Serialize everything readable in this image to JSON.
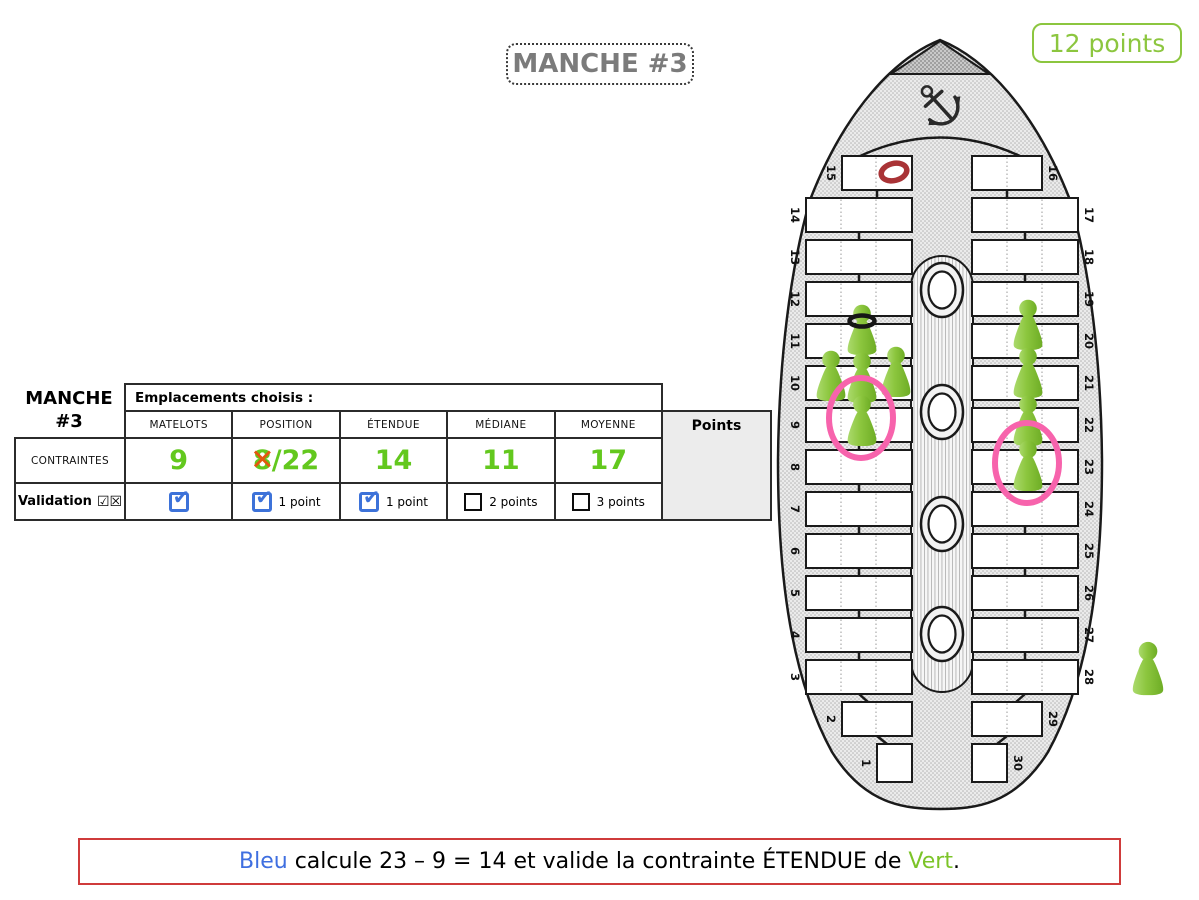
{
  "title_box": {
    "label": "MANCHE #3"
  },
  "score_badge": {
    "label": "12 points",
    "color": "#8CC63F"
  },
  "table": {
    "round_label_line1": "MANCHE",
    "round_label_line2": "#3",
    "header_span": "Emplacements choisis :",
    "points_header": "Points",
    "columns": [
      "MATELOTS",
      "POSITION",
      "ÉTENDUE",
      "MÉDIANE",
      "MOYENNE"
    ],
    "contraintes": {
      "label": "CONTRAINTES",
      "values": [
        {
          "struck": "",
          "text": "9"
        },
        {
          "struck": "8",
          "text": "/22"
        },
        {
          "struck": "",
          "text": "14"
        },
        {
          "struck": "",
          "text": "11"
        },
        {
          "struck": "",
          "text": "17"
        }
      ],
      "value_color": "#63C81E",
      "strike_color": "#E2570F"
    },
    "validation": {
      "label": "Validation",
      "glyphs": "☑☒",
      "cells": [
        {
          "checked": true,
          "points_label": ""
        },
        {
          "checked": true,
          "points_label": "1 point"
        },
        {
          "checked": true,
          "points_label": "1 point"
        },
        {
          "checked": false,
          "points_label": "2 points"
        },
        {
          "checked": false,
          "points_label": "3 points"
        }
      ],
      "check_color": "#3D72D9"
    }
  },
  "boat": {
    "left_numbers": [
      "15",
      "14",
      "13",
      "12",
      "11",
      "10",
      "9",
      "8",
      "7",
      "6",
      "5",
      "4",
      "3",
      "2",
      "1"
    ],
    "right_numbers": [
      "16",
      "17",
      "18",
      "19",
      "20",
      "21",
      "22",
      "23",
      "24",
      "25",
      "26",
      "27",
      "28",
      "29",
      "30"
    ],
    "red_ring_slot": "15",
    "pawns": [
      {
        "slot": "11",
        "accessory": "black-ring"
      },
      {
        "slot": "10L"
      },
      {
        "slot": "10M"
      },
      {
        "slot": "10R"
      },
      {
        "slot": "9",
        "highlight": "pink-circle"
      },
      {
        "slot": "20"
      },
      {
        "slot": "21"
      },
      {
        "slot": "22"
      },
      {
        "slot": "23",
        "highlight": "pink-circle"
      },
      {
        "slot": "reserve"
      }
    ],
    "pawn_color": "#8CC63E",
    "highlight_color": "#F763AC",
    "red_ring_color": "#A93336"
  },
  "message": {
    "parts": [
      {
        "text": "Bleu",
        "color": "#3F6FE0"
      },
      {
        "text": " calcule 23 – 9 = 14 et valide la contrainte ÉTENDUE de ",
        "color": "#000000"
      },
      {
        "text": "Vert",
        "color": "#7CC428"
      },
      {
        "text": ".",
        "color": "#000000"
      }
    ]
  }
}
